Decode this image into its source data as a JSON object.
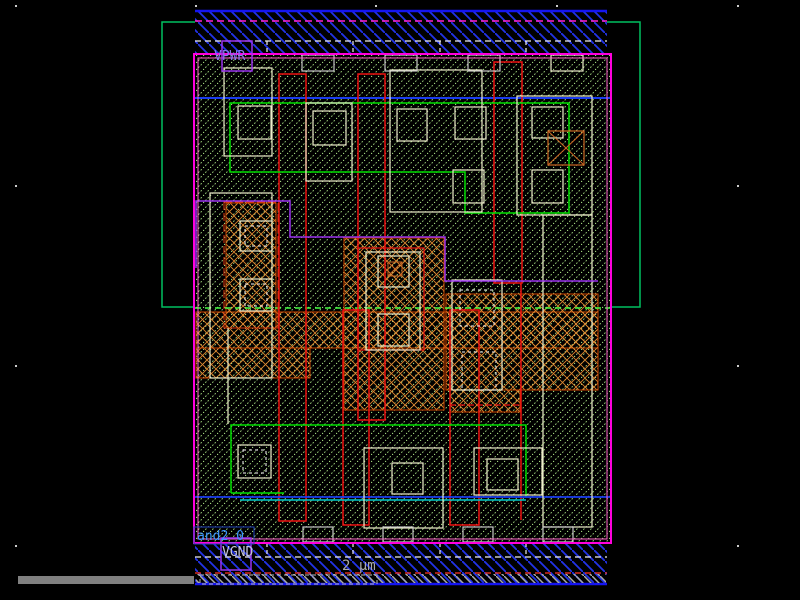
{
  "window": {
    "title": "VLSI layout viewer canvas",
    "width": 800,
    "height": 600,
    "background": "#000000"
  },
  "labels": {
    "vpwr": "VPWR",
    "vgnd": "VGND",
    "cell_name": "and2_0",
    "scale": "2 µm"
  },
  "colors": {
    "cell_hatch": "#b4f08c",
    "rail_hatch": "#2233e8",
    "rail_edge": "#1515f0",
    "magenta_border": "#ff00dd",
    "pink_inner": "#ff66cc",
    "nwell_green": "#00c060",
    "bright_green": "#00e000",
    "dashed_green": "#44ff44",
    "blue_line": "#1a3cf0",
    "cyan_line": "#00c8c8",
    "red_poly": "#ee1111",
    "orange_diff": "#e08830",
    "diff_outline": "#cc4400",
    "li_yellow": "#eeeecc",
    "contact_gray": "#c8c8c8",
    "purple_met": "#9933ee",
    "vpwr_text": "#8877ee",
    "vgnd_text": "#c8c8dc",
    "cellname_text": "#3c96ff",
    "scale_text": "#aaaaaa",
    "scalebar_gray": "#808080",
    "grid_dot": "#cccccc"
  },
  "grid": {
    "xs": [
      15,
      195,
      375,
      556,
      737
    ],
    "ys": [
      5,
      185,
      365,
      545
    ]
  },
  "shapes": [
    {
      "t": "rect",
      "name": "nwell-boundary",
      "x": 162,
      "y": 22,
      "w": 478,
      "h": 285,
      "stroke": "#00c060",
      "sw": 1.5
    },
    {
      "t": "rect",
      "name": "cell-area-fill",
      "x": 195,
      "y": 55,
      "w": 415,
      "h": 488,
      "fill": "#000000"
    },
    {
      "t": "rect",
      "name": "cell-area-hatch",
      "x": 195,
      "y": 55,
      "w": 415,
      "h": 488,
      "fill": "url(#hatchCell)"
    },
    {
      "t": "line",
      "name": "metal-track-top",
      "x1": 195,
      "y1": 98,
      "x2": 610,
      "y2": 98,
      "stroke": "#1a3cf0",
      "sw": 2
    },
    {
      "t": "rect",
      "name": "diff-band",
      "x": 196,
      "y": 312,
      "w": 402,
      "h": 36,
      "fill": "url(#hatchX)",
      "stroke": "#cc4400",
      "sw": 1
    },
    {
      "t": "rect",
      "name": "diff-left-low",
      "x": 196,
      "y": 348,
      "w": 114,
      "h": 30,
      "fill": "url(#hatchX)",
      "stroke": "#cc4400",
      "sw": 1
    },
    {
      "t": "rect",
      "name": "diff-left-tap",
      "x": 226,
      "y": 203,
      "w": 50,
      "h": 125,
      "fill": "url(#hatchX)",
      "stroke": "#cc4400",
      "sw": 1
    },
    {
      "t": "rect",
      "name": "diff-center-col",
      "x": 344,
      "y": 238,
      "w": 100,
      "h": 172,
      "fill": "url(#hatchX)",
      "stroke": "#cc4400",
      "sw": 1
    },
    {
      "t": "rect",
      "name": "diff-right",
      "x": 446,
      "y": 294,
      "w": 152,
      "h": 96,
      "fill": "url(#hatchX)",
      "stroke": "#cc4400",
      "sw": 1
    },
    {
      "t": "rect",
      "name": "diff-right-stub",
      "x": 450,
      "y": 390,
      "w": 70,
      "h": 22,
      "fill": "url(#hatchX)",
      "stroke": "#cc4400",
      "sw": 1
    },
    {
      "t": "line",
      "name": "nwell-edge-dashed",
      "x1": 195,
      "y1": 308,
      "x2": 610,
      "y2": 308,
      "stroke": "#44ff44",
      "sw": 1.5,
      "dash": "6,4"
    },
    {
      "t": "rect",
      "name": "poly-gate-1",
      "x": 279,
      "y": 74,
      "w": 27,
      "h": 447,
      "stroke": "#ee1111",
      "sw": 1.5
    },
    {
      "t": "rect",
      "name": "poly-gate-2",
      "x": 358,
      "y": 74,
      "w": 27,
      "h": 346,
      "stroke": "#ee1111",
      "sw": 1.5
    },
    {
      "t": "rect",
      "name": "poly-gate-3",
      "x": 343,
      "y": 310,
      "w": 26,
      "h": 215,
      "stroke": "#ee1111",
      "sw": 1.5
    },
    {
      "t": "rect",
      "name": "poly-gate-4",
      "x": 494,
      "y": 62,
      "w": 28,
      "h": 221,
      "stroke": "#ee1111",
      "sw": 1.5
    },
    {
      "t": "line",
      "name": "poly-gate-4-leg",
      "x1": 521,
      "y1": 283,
      "x2": 521,
      "y2": 520,
      "stroke": "#ee1111",
      "sw": 1.5
    },
    {
      "t": "rect",
      "name": "poly-gate-5",
      "x": 450,
      "y": 310,
      "w": 29,
      "h": 215,
      "stroke": "#ee1111",
      "sw": 1.5
    },
    {
      "t": "rect",
      "name": "diff-center-outline",
      "x": 358,
      "y": 248,
      "w": 66,
      "h": 102,
      "stroke": "#ee1111",
      "sw": 1.2
    },
    {
      "t": "rect",
      "name": "diff-lefttap-outline",
      "x": 224,
      "y": 202,
      "w": 54,
      "h": 126,
      "stroke": "#dd3311",
      "sw": 1,
      "dash": "8,3"
    },
    {
      "t": "line",
      "name": "diff-stub-edge",
      "x1": 450,
      "y1": 405,
      "x2": 520,
      "y2": 405,
      "stroke": "#ee1111",
      "sw": 1.2,
      "dash": "6,3"
    },
    {
      "t": "path",
      "name": "licon-green-top",
      "d": "M230,103 H569 V213 H465 V172 H230 Z",
      "stroke": "#00e000",
      "sw": 1.5
    },
    {
      "t": "path",
      "name": "licon-green-bottom",
      "d": "M231,493 V425 H526 V497",
      "stroke": "#00e000",
      "sw": 1.5
    },
    {
      "t": "line",
      "name": "licon-green-bottom-edge",
      "x1": 231,
      "y1": 493,
      "x2": 284,
      "y2": 493,
      "stroke": "#00e000",
      "sw": 1.5
    },
    {
      "t": "line",
      "name": "cyan-track",
      "x1": 240,
      "y1": 500,
      "x2": 526,
      "y2": 500,
      "stroke": "#00c8c8",
      "sw": 1.5
    },
    {
      "t": "line",
      "name": "blue-track-bottom",
      "x1": 195,
      "y1": 497,
      "x2": 610,
      "y2": 497,
      "stroke": "#1a3cf0",
      "sw": 1.8
    },
    {
      "t": "rect",
      "name": "li-box",
      "x": 224,
      "y": 68,
      "w": 48,
      "h": 88,
      "stroke": "#eeeecc",
      "sw": 1.2
    },
    {
      "t": "rect",
      "name": "contact",
      "x": 238,
      "y": 106,
      "w": 33,
      "h": 33,
      "stroke": "#eeeecc",
      "sw": 1.2
    },
    {
      "t": "rect",
      "name": "li-box",
      "x": 306,
      "y": 103,
      "w": 46,
      "h": 78,
      "stroke": "#eeeecc",
      "sw": 1.2
    },
    {
      "t": "rect",
      "name": "contact",
      "x": 313,
      "y": 111,
      "w": 33,
      "h": 34,
      "stroke": "#eeeecc",
      "sw": 1.2
    },
    {
      "t": "rect",
      "name": "li-box",
      "x": 390,
      "y": 70,
      "w": 92,
      "h": 142,
      "stroke": "#eeeecc",
      "sw": 1.2
    },
    {
      "t": "rect",
      "name": "contact",
      "x": 397,
      "y": 109,
      "w": 30,
      "h": 32,
      "stroke": "#eeeecc",
      "sw": 1.2
    },
    {
      "t": "rect",
      "name": "contact",
      "x": 455,
      "y": 107,
      "w": 31,
      "h": 32,
      "stroke": "#eeeecc",
      "sw": 1.2
    },
    {
      "t": "rect",
      "name": "contact",
      "x": 453,
      "y": 170,
      "w": 31,
      "h": 33,
      "stroke": "#eeeecc",
      "sw": 1.2
    },
    {
      "t": "rect",
      "name": "li-box",
      "x": 517,
      "y": 96,
      "w": 75,
      "h": 119,
      "stroke": "#eeeecc",
      "sw": 1.2
    },
    {
      "t": "rect",
      "name": "contact",
      "x": 532,
      "y": 107,
      "w": 31,
      "h": 31,
      "stroke": "#eeeecc",
      "sw": 1.2
    },
    {
      "t": "rect",
      "name": "contact",
      "x": 532,
      "y": 170,
      "w": 31,
      "h": 33,
      "stroke": "#eeeecc",
      "sw": 1.2
    },
    {
      "t": "rect",
      "name": "li-band-right",
      "x": 543,
      "y": 215,
      "w": 49,
      "h": 312,
      "stroke": "#eeeecc",
      "sw": 1.2
    },
    {
      "t": "rect",
      "name": "li-box",
      "x": 210,
      "y": 193,
      "w": 62,
      "h": 185,
      "stroke": "#eeeecc",
      "sw": 1.2
    },
    {
      "t": "rect",
      "name": "contact",
      "x": 240,
      "y": 221,
      "w": 32,
      "h": 30,
      "stroke": "#eeeecc",
      "sw": 1.2
    },
    {
      "t": "rect",
      "name": "contact-inner",
      "x": 245,
      "y": 226,
      "w": 22,
      "h": 20,
      "stroke": "#ffffff",
      "sw": 1,
      "dash": "3,3"
    },
    {
      "t": "rect",
      "name": "contact",
      "x": 240,
      "y": 279,
      "w": 32,
      "h": 32,
      "stroke": "#eeeecc",
      "sw": 1.2
    },
    {
      "t": "rect",
      "name": "contact-inner",
      "x": 245,
      "y": 284,
      "w": 22,
      "h": 22,
      "stroke": "#ffffff",
      "sw": 1,
      "dash": "3,3"
    },
    {
      "t": "rect",
      "name": "li-box",
      "x": 366,
      "y": 252,
      "w": 54,
      "h": 98,
      "stroke": "#eeeecc",
      "sw": 1.2
    },
    {
      "t": "rect",
      "name": "contact",
      "x": 378,
      "y": 256,
      "w": 31,
      "h": 31,
      "stroke": "#eeeecc",
      "sw": 1.2
    },
    {
      "t": "rect",
      "name": "contact",
      "x": 378,
      "y": 314,
      "w": 31,
      "h": 32,
      "stroke": "#eeeecc",
      "sw": 1.2
    },
    {
      "t": "rect",
      "name": "li-box",
      "x": 452,
      "y": 280,
      "w": 50,
      "h": 110,
      "stroke": "#eeeecc",
      "sw": 1.2
    },
    {
      "t": "rect",
      "name": "contact-inner",
      "x": 460,
      "y": 290,
      "w": 34,
      "h": 36,
      "stroke": "#ffffff",
      "sw": 1,
      "dash": "3,3"
    },
    {
      "t": "rect",
      "name": "contact-inner",
      "x": 462,
      "y": 352,
      "w": 34,
      "h": 38,
      "stroke": "#ffffff",
      "sw": 1,
      "dash": "3,3"
    },
    {
      "t": "rect",
      "name": "contact",
      "x": 238,
      "y": 445,
      "w": 33,
      "h": 33,
      "stroke": "#eeeecc",
      "sw": 1.2
    },
    {
      "t": "rect",
      "name": "contact-inner",
      "x": 243,
      "y": 450,
      "w": 23,
      "h": 23,
      "stroke": "#ffffff",
      "sw": 1,
      "dash": "3,3"
    },
    {
      "t": "rect",
      "name": "li-box",
      "x": 364,
      "y": 448,
      "w": 79,
      "h": 80,
      "stroke": "#eeeecc",
      "sw": 1.2
    },
    {
      "t": "rect",
      "name": "contact",
      "x": 392,
      "y": 463,
      "w": 31,
      "h": 31,
      "stroke": "#eeeecc",
      "sw": 1.2
    },
    {
      "t": "rect",
      "name": "li-box",
      "x": 474,
      "y": 448,
      "w": 68,
      "h": 47,
      "stroke": "#eeeecc",
      "sw": 1.2
    },
    {
      "t": "rect",
      "name": "contact",
      "x": 487,
      "y": 459,
      "w": 31,
      "h": 31,
      "stroke": "#eeeecc",
      "sw": 1.2
    },
    {
      "t": "line",
      "name": "li-stub",
      "x1": 228,
      "y1": 328,
      "x2": 228,
      "y2": 424,
      "stroke": "#eeeecc",
      "sw": 1.2
    },
    {
      "t": "rect",
      "name": "via-box",
      "x": 548,
      "y": 131,
      "w": 36,
      "h": 34,
      "stroke": "#cc6622",
      "sw": 1.2
    },
    {
      "t": "line",
      "name": "via-x",
      "x1": 548,
      "y1": 131,
      "x2": 584,
      "y2": 165,
      "stroke": "#cc6622",
      "sw": 1
    },
    {
      "t": "line",
      "name": "via-x",
      "x1": 584,
      "y1": 131,
      "x2": 548,
      "y2": 165,
      "stroke": "#cc6622",
      "sw": 1
    },
    {
      "t": "rect",
      "name": "via-box",
      "x": 388,
      "y": 262,
      "w": 14,
      "h": 14,
      "stroke": "#cc6622",
      "sw": 1
    },
    {
      "t": "line",
      "name": "via-x",
      "x1": 388,
      "y1": 262,
      "x2": 402,
      "y2": 276,
      "stroke": "#cc6622",
      "sw": 1
    },
    {
      "t": "line",
      "name": "via-x",
      "x1": 402,
      "y1": 262,
      "x2": 388,
      "y2": 276,
      "stroke": "#cc6622",
      "sw": 1
    },
    {
      "t": "path",
      "name": "met-purple-route",
      "d": "M196,268 V201 H290 V237 H445 V281 H598",
      "stroke": "#9933ee",
      "sw": 1.5
    },
    {
      "t": "rect",
      "name": "vpwr-rail-fill",
      "x": 195,
      "y": 10,
      "w": 412,
      "h": 45,
      "fill": "#000000"
    },
    {
      "t": "rect",
      "name": "vpwr-rail-hatch",
      "x": 195,
      "y": 10,
      "w": 412,
      "h": 45,
      "fill": "url(#hatchRail)"
    },
    {
      "t": "line",
      "name": "vpwr-rail-edge",
      "x1": 195,
      "y1": 11,
      "x2": 607,
      "y2": 11,
      "stroke": "#1515f0",
      "sw": 2.5
    },
    {
      "t": "line",
      "name": "vpwr-met-dashed",
      "x1": 195,
      "y1": 21,
      "x2": 607,
      "y2": 21,
      "stroke": "#ff22cc",
      "sw": 1.5,
      "dash": "7,4"
    },
    {
      "t": "line",
      "name": "vpwr-li-dashed",
      "x1": 195,
      "y1": 41,
      "x2": 607,
      "y2": 41,
      "stroke": "#eeeeee",
      "sw": 1.2,
      "dash": "6,4"
    },
    {
      "t": "line",
      "name": "rail-tick",
      "x1": 267,
      "y1": 41,
      "x2": 267,
      "y2": 55,
      "stroke": "#eeeeee",
      "sw": 1.2,
      "dash": "4,3"
    },
    {
      "t": "line",
      "name": "rail-tick",
      "x1": 353,
      "y1": 41,
      "x2": 353,
      "y2": 55,
      "stroke": "#eeeeee",
      "sw": 1.2,
      "dash": "4,3"
    },
    {
      "t": "line",
      "name": "rail-tick",
      "x1": 440,
      "y1": 41,
      "x2": 440,
      "y2": 55,
      "stroke": "#eeeeee",
      "sw": 1.2,
      "dash": "4,3"
    },
    {
      "t": "line",
      "name": "rail-tick",
      "x1": 526,
      "y1": 41,
      "x2": 526,
      "y2": 55,
      "stroke": "#eeeeee",
      "sw": 1.2,
      "dash": "4,3"
    },
    {
      "t": "rect",
      "name": "rail-contact",
      "x": 302,
      "y": 55,
      "w": 32,
      "h": 16,
      "stroke": "#c8c8c8",
      "sw": 1.2
    },
    {
      "t": "rect",
      "name": "rail-contact",
      "x": 385,
      "y": 55,
      "w": 32,
      "h": 16,
      "stroke": "#c8c8c8",
      "sw": 1.2
    },
    {
      "t": "rect",
      "name": "rail-contact",
      "x": 468,
      "y": 55,
      "w": 32,
      "h": 16,
      "stroke": "#c8c8c8",
      "sw": 1.2
    },
    {
      "t": "rect",
      "name": "rail-contact",
      "x": 551,
      "y": 55,
      "w": 32,
      "h": 16,
      "stroke": "#eeeecc",
      "sw": 1.2
    },
    {
      "t": "rect",
      "name": "vgnd-rail-fill",
      "x": 195,
      "y": 543,
      "w": 412,
      "h": 42,
      "fill": "#000000"
    },
    {
      "t": "rect",
      "name": "vgnd-rail-hatch",
      "x": 195,
      "y": 543,
      "w": 412,
      "h": 42,
      "fill": "url(#hatchRail)"
    },
    {
      "t": "line",
      "name": "vgnd-rail-edge",
      "x1": 195,
      "y1": 584,
      "x2": 607,
      "y2": 584,
      "stroke": "#1515f0",
      "sw": 2.5
    },
    {
      "t": "line",
      "name": "vgnd-li-dashed",
      "x1": 195,
      "y1": 557,
      "x2": 607,
      "y2": 557,
      "stroke": "#eeeeee",
      "sw": 1.2,
      "dash": "6,4"
    },
    {
      "t": "line",
      "name": "rail-tick",
      "x1": 267,
      "y1": 543,
      "x2": 267,
      "y2": 557,
      "stroke": "#eeeeee",
      "sw": 1.2,
      "dash": "4,3"
    },
    {
      "t": "line",
      "name": "rail-tick",
      "x1": 353,
      "y1": 543,
      "x2": 353,
      "y2": 557,
      "stroke": "#eeeeee",
      "sw": 1.2,
      "dash": "4,3"
    },
    {
      "t": "line",
      "name": "rail-tick",
      "x1": 440,
      "y1": 543,
      "x2": 440,
      "y2": 557,
      "stroke": "#eeeeee",
      "sw": 1.2,
      "dash": "4,3"
    },
    {
      "t": "line",
      "name": "rail-tick",
      "x1": 526,
      "y1": 543,
      "x2": 526,
      "y2": 557,
      "stroke": "#eeeeee",
      "sw": 1.2,
      "dash": "4,3"
    },
    {
      "t": "rect",
      "name": "rail-contact",
      "x": 303,
      "y": 527,
      "w": 30,
      "h": 15,
      "stroke": "#c8c8c8",
      "sw": 1.2
    },
    {
      "t": "rect",
      "name": "rail-contact",
      "x": 383,
      "y": 527,
      "w": 30,
      "h": 15,
      "stroke": "#c8c8c8",
      "sw": 1.2
    },
    {
      "t": "rect",
      "name": "rail-contact",
      "x": 463,
      "y": 527,
      "w": 30,
      "h": 15,
      "stroke": "#c8c8c8",
      "sw": 1.2
    },
    {
      "t": "rect",
      "name": "rail-contact",
      "x": 543,
      "y": 527,
      "w": 30,
      "h": 15,
      "stroke": "#c8c8c8",
      "sw": 1.2
    },
    {
      "t": "line",
      "name": "red-guide-dashed",
      "x1": 195,
      "y1": 573,
      "x2": 607,
      "y2": 573,
      "stroke": "#ff3322",
      "sw": 1.2,
      "dash": "6,4"
    },
    {
      "t": "rect",
      "name": "gray-hatch-band",
      "x": 196,
      "y": 574,
      "w": 410,
      "h": 9,
      "fill": "url(#hatchGray)"
    },
    {
      "t": "rect",
      "name": "scale-bar",
      "x": 200,
      "y": 575,
      "w": 177,
      "h": 9,
      "stroke": "#bbbbbb",
      "sw": 1,
      "dash": "4,3"
    },
    {
      "t": "rect",
      "name": "cell-boundary",
      "x": 194,
      "y": 54,
      "w": 417,
      "h": 489,
      "stroke": "#ff00dd",
      "sw": 2
    },
    {
      "t": "rect",
      "name": "cell-boundary-inner",
      "x": 198,
      "y": 58,
      "w": 409,
      "h": 481,
      "stroke": "#ff66cc",
      "sw": 1
    },
    {
      "t": "rect",
      "name": "vpwr-pin-box",
      "x": 222,
      "y": 41,
      "w": 30,
      "h": 30,
      "stroke": "#9933ee",
      "sw": 1.5
    },
    {
      "t": "rect",
      "name": "vgnd-pin-box",
      "x": 221,
      "y": 538,
      "w": 30,
      "h": 32,
      "stroke": "#9933ee",
      "sw": 1.5
    },
    {
      "t": "rect",
      "name": "cell-name-box",
      "x": 194,
      "y": 527,
      "w": 60,
      "h": 17,
      "stroke": "#2244bb",
      "sw": 1
    },
    {
      "t": "text",
      "name": "vpwr-label",
      "bind": "labels.vpwr",
      "x": 214,
      "y": 60,
      "fill": "#8877ee",
      "size": 13
    },
    {
      "t": "text",
      "name": "vgnd-label",
      "bind": "labels.vgnd",
      "x": 222,
      "y": 556,
      "fill": "#c8c8dc",
      "size": 13
    },
    {
      "t": "text",
      "name": "cell-name-label",
      "bind": "labels.cell_name",
      "x": 197,
      "y": 540,
      "fill": "#3c96ff",
      "size": 13
    },
    {
      "t": "text",
      "name": "scale-label",
      "bind": "labels.scale",
      "x": 342,
      "y": 570,
      "fill": "#aaaaaa",
      "size": 14
    },
    {
      "t": "rect",
      "name": "scale-ruler-bar",
      "x": 18,
      "y": 576,
      "w": 176,
      "h": 8,
      "fill": "#808080"
    }
  ]
}
